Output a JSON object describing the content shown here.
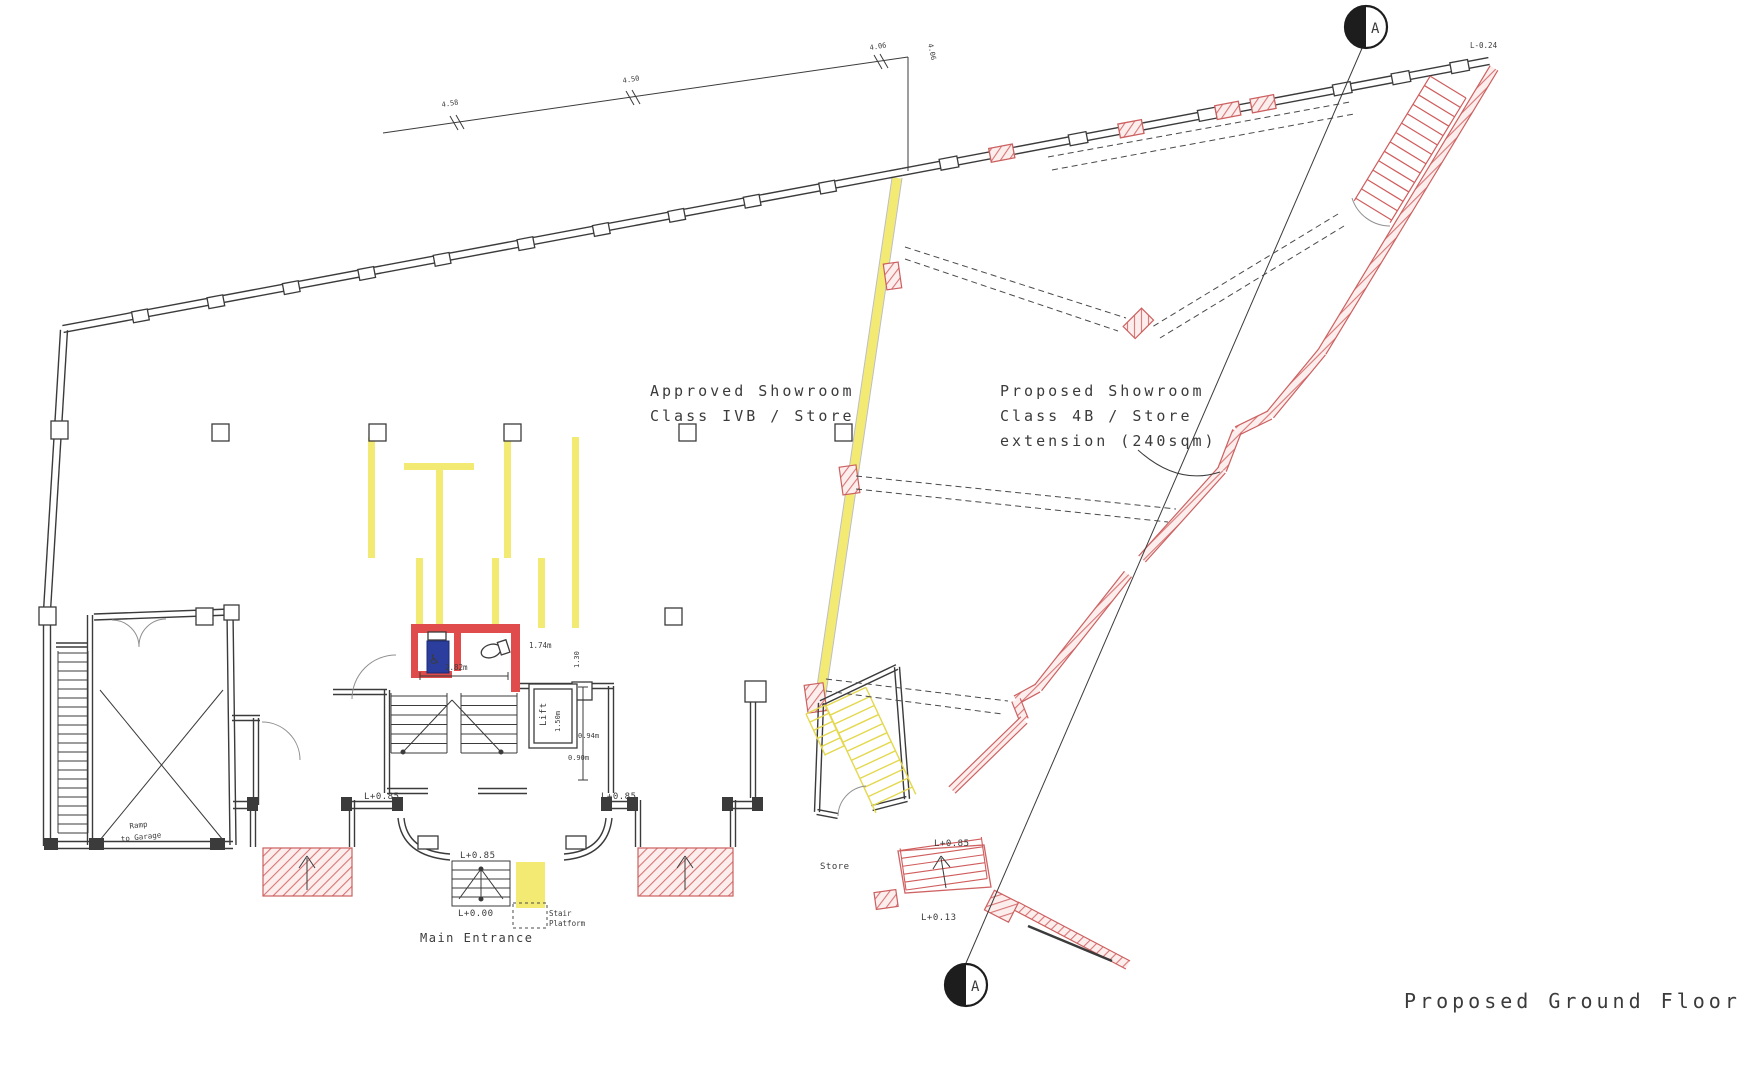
{
  "title": "Proposed Ground Floor",
  "rooms": {
    "approved_line1": "Approved Showroom",
    "approved_line2": "Class IVB / Store",
    "proposed_line1": "Proposed Showroom",
    "proposed_line2": "Class 4B / Store",
    "proposed_line3": "extension (240sqm)",
    "store": "Store",
    "ramp_line1": "Ramp",
    "ramp_line2": "to Garage",
    "lift": "Lift"
  },
  "entrance": {
    "label": "Main Entrance",
    "stair_platform_line1": "Stair",
    "stair_platform_line2": "Platform"
  },
  "levels": {
    "l085": "L+0.85",
    "l000": "L+0.00",
    "l013": "L+0.13",
    "lm024": "L-0.24"
  },
  "dimensions": {
    "d282": "2.82m",
    "d174": "1.74m",
    "d130": "1.30",
    "d150": "1.50m",
    "d094": "0.94m",
    "d090": "0.90m"
  },
  "boundary_dims": {
    "b1": "4.58",
    "b2": "4.50",
    "b3": "4.06"
  },
  "section": {
    "marker": "A"
  },
  "icons": {
    "accessible_wc": "♿"
  },
  "colors": {
    "red": "#d85f5f",
    "yellow": "#f3ea73",
    "blue": "#2b3e9e",
    "line": "#3b3b3b"
  }
}
